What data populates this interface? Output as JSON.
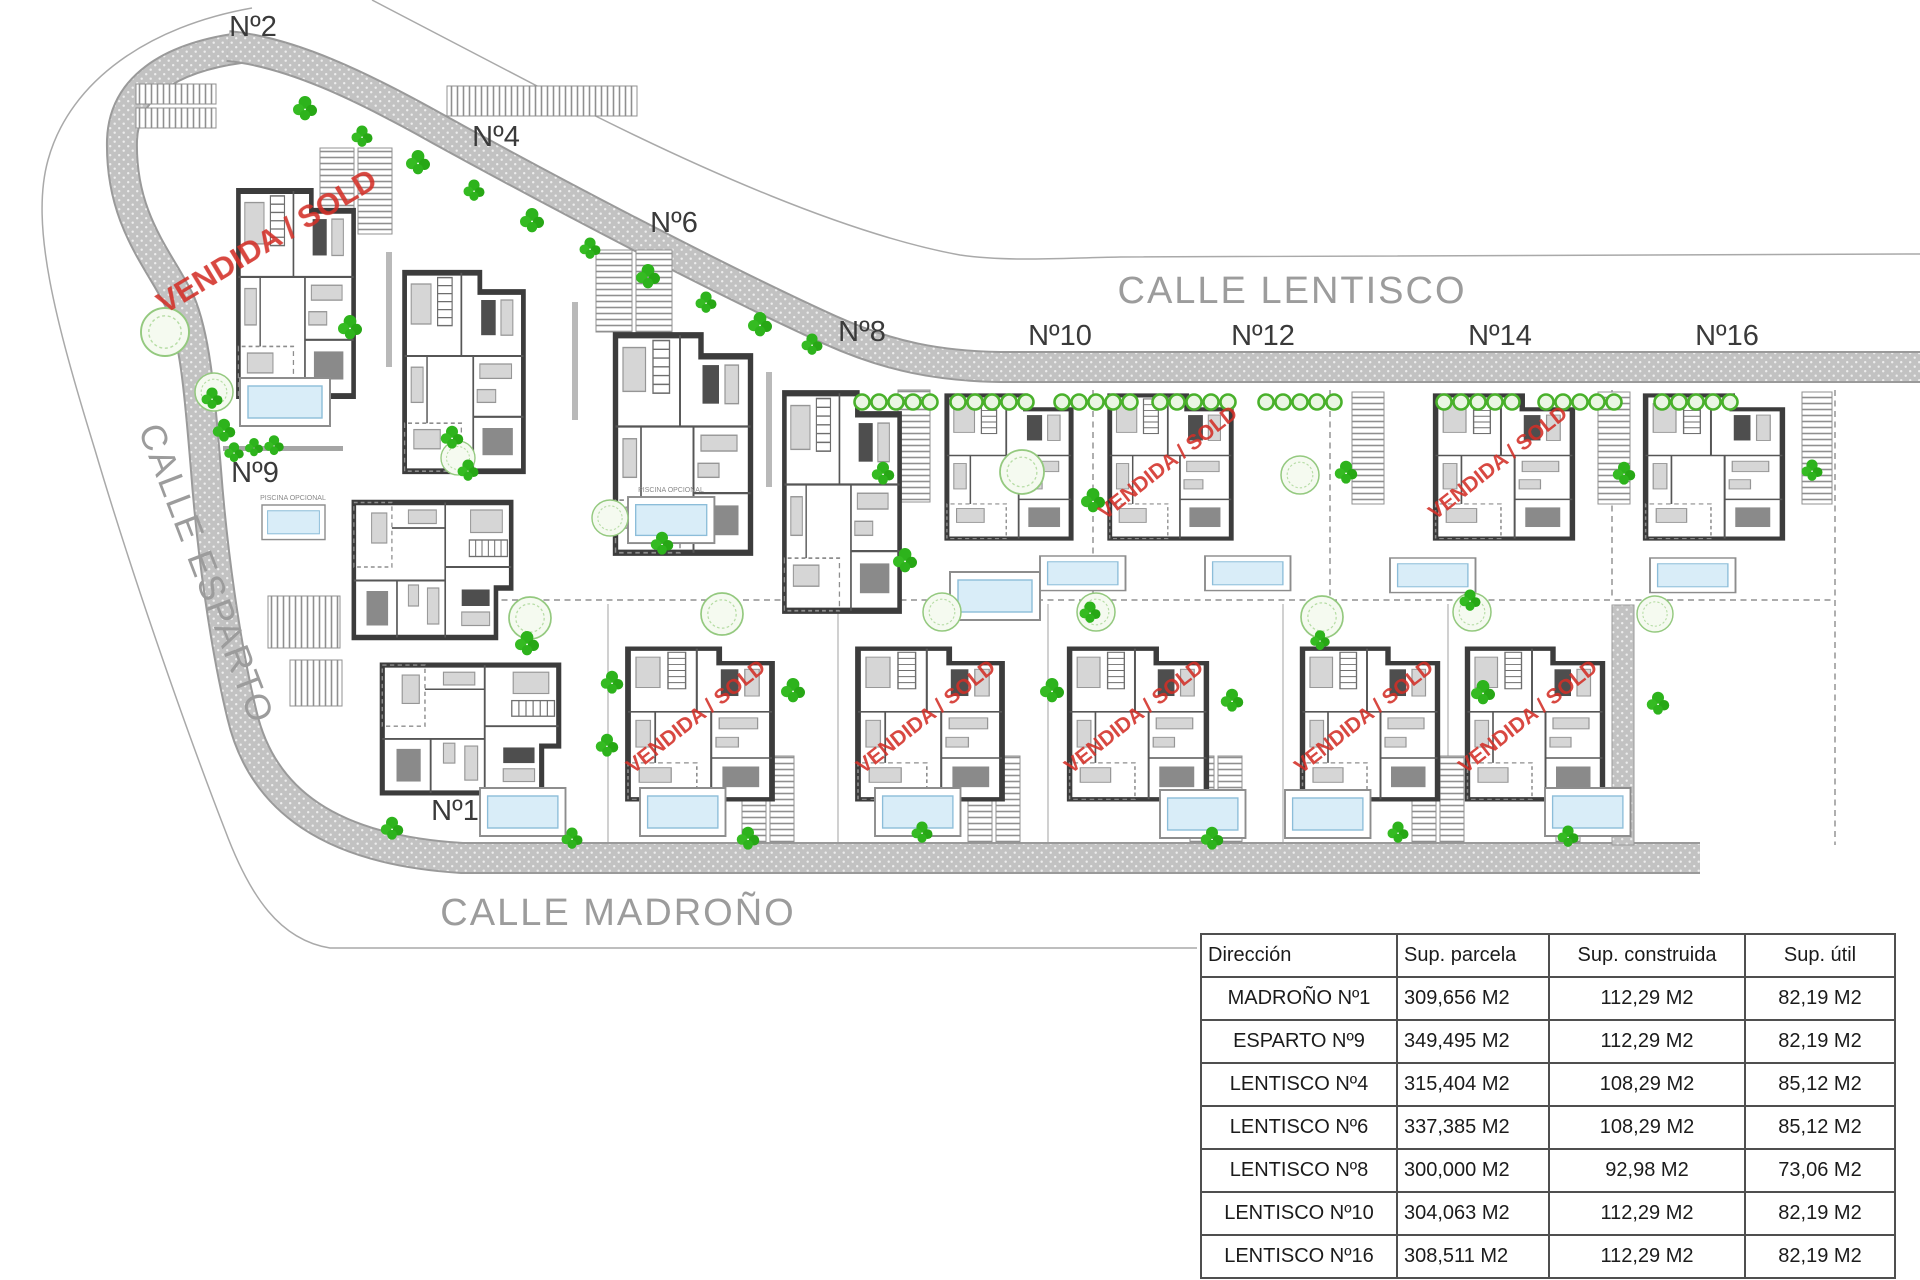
{
  "plan": {
    "streets": [
      {
        "name": "CALLE LENTISCO"
      },
      {
        "name": "CALLE ESPARTO"
      },
      {
        "name": "CALLE MADROÑO"
      }
    ],
    "plots": [
      {
        "label": "Nº2"
      },
      {
        "label": "Nº4"
      },
      {
        "label": "Nº6"
      },
      {
        "label": "Nº8"
      },
      {
        "label": "Nº10"
      },
      {
        "label": "Nº12"
      },
      {
        "label": "Nº14"
      },
      {
        "label": "Nº16"
      },
      {
        "label": "Nº9"
      },
      {
        "label": "Nº1"
      }
    ],
    "sold_stamp_label": "VENDIDA / SOLD",
    "pool_label": "PISCINA OPCIONAL",
    "colors": {
      "stamp_red": "#d32f27",
      "street_text_gray": "#9c9c9c",
      "road_gray": "#c2c2c2",
      "tree_green": "#2db31c",
      "shrub_ring_green": "#49b12b",
      "pool_blue": "#d9edf8",
      "wall_dark": "#3c3c3c"
    }
  },
  "table": {
    "headers": [
      "Dirección",
      "Sup. parcela",
      "Sup. construida",
      "Sup. útil"
    ],
    "rows": [
      [
        "MADROÑO Nº1",
        "309,656 M2",
        "112,29 M2",
        "82,19 M2"
      ],
      [
        "ESPARTO Nº9",
        "349,495 M2",
        "112,29 M2",
        "82,19 M2"
      ],
      [
        "LENTISCO Nº4",
        "315,404 M2",
        "108,29 M2",
        "85,12 M2"
      ],
      [
        "LENTISCO Nº6",
        "337,385 M2",
        "108,29 M2",
        "85,12 M2"
      ],
      [
        "LENTISCO Nº8",
        "300,000 M2",
        "92,98 M2",
        "73,06 M2"
      ],
      [
        "LENTISCO Nº10",
        "304,063 M2",
        "112,29 M2",
        "82,19 M2"
      ],
      [
        "LENTISCO Nº16",
        "308,511 M2",
        "112,29 M2",
        "82,19 M2"
      ]
    ]
  }
}
